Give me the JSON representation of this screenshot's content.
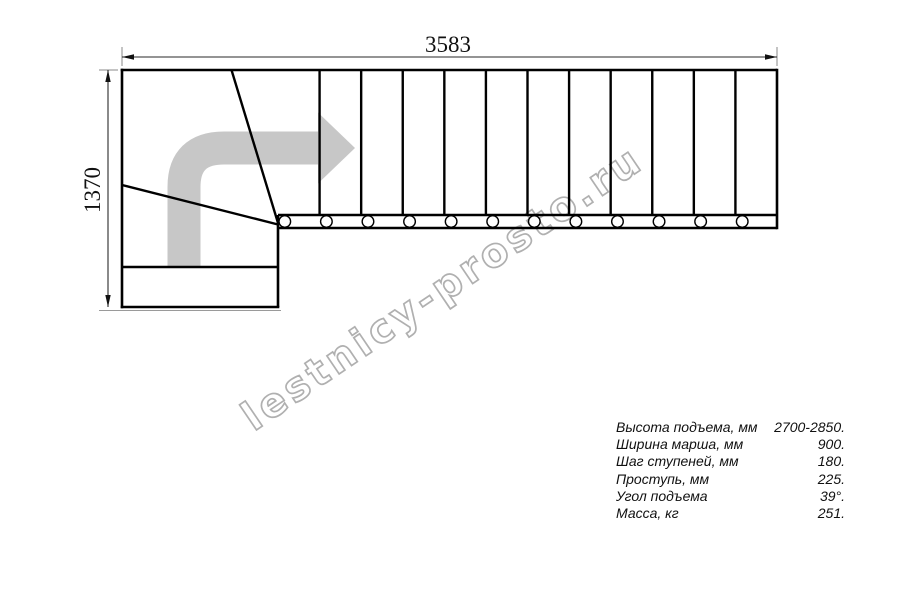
{
  "drawing": {
    "top_dimension_label": "3583",
    "left_dimension_label": "1370",
    "watermark_text": "lestnicy-prosto.ru",
    "tread_count": 12,
    "colors": {
      "line": "#000000",
      "dimension_line": "#2a2a2a",
      "extension_line": "#8a8a8a",
      "direction_arrow": "#c7c7c7",
      "watermark_outline": "#b0b0b0"
    }
  },
  "specs": {
    "rows": [
      {
        "label": "Высота подъема, мм",
        "value": "2700-2850."
      },
      {
        "label": "Ширина марша, мм",
        "value": "900."
      },
      {
        "label": "Шаг ступеней, мм",
        "value": "180."
      },
      {
        "label": "Проступь, мм",
        "value": "225."
      },
      {
        "label": "Угол подъема",
        "value": "39°."
      },
      {
        "label": "Масса, кг",
        "value": "251."
      }
    ]
  }
}
